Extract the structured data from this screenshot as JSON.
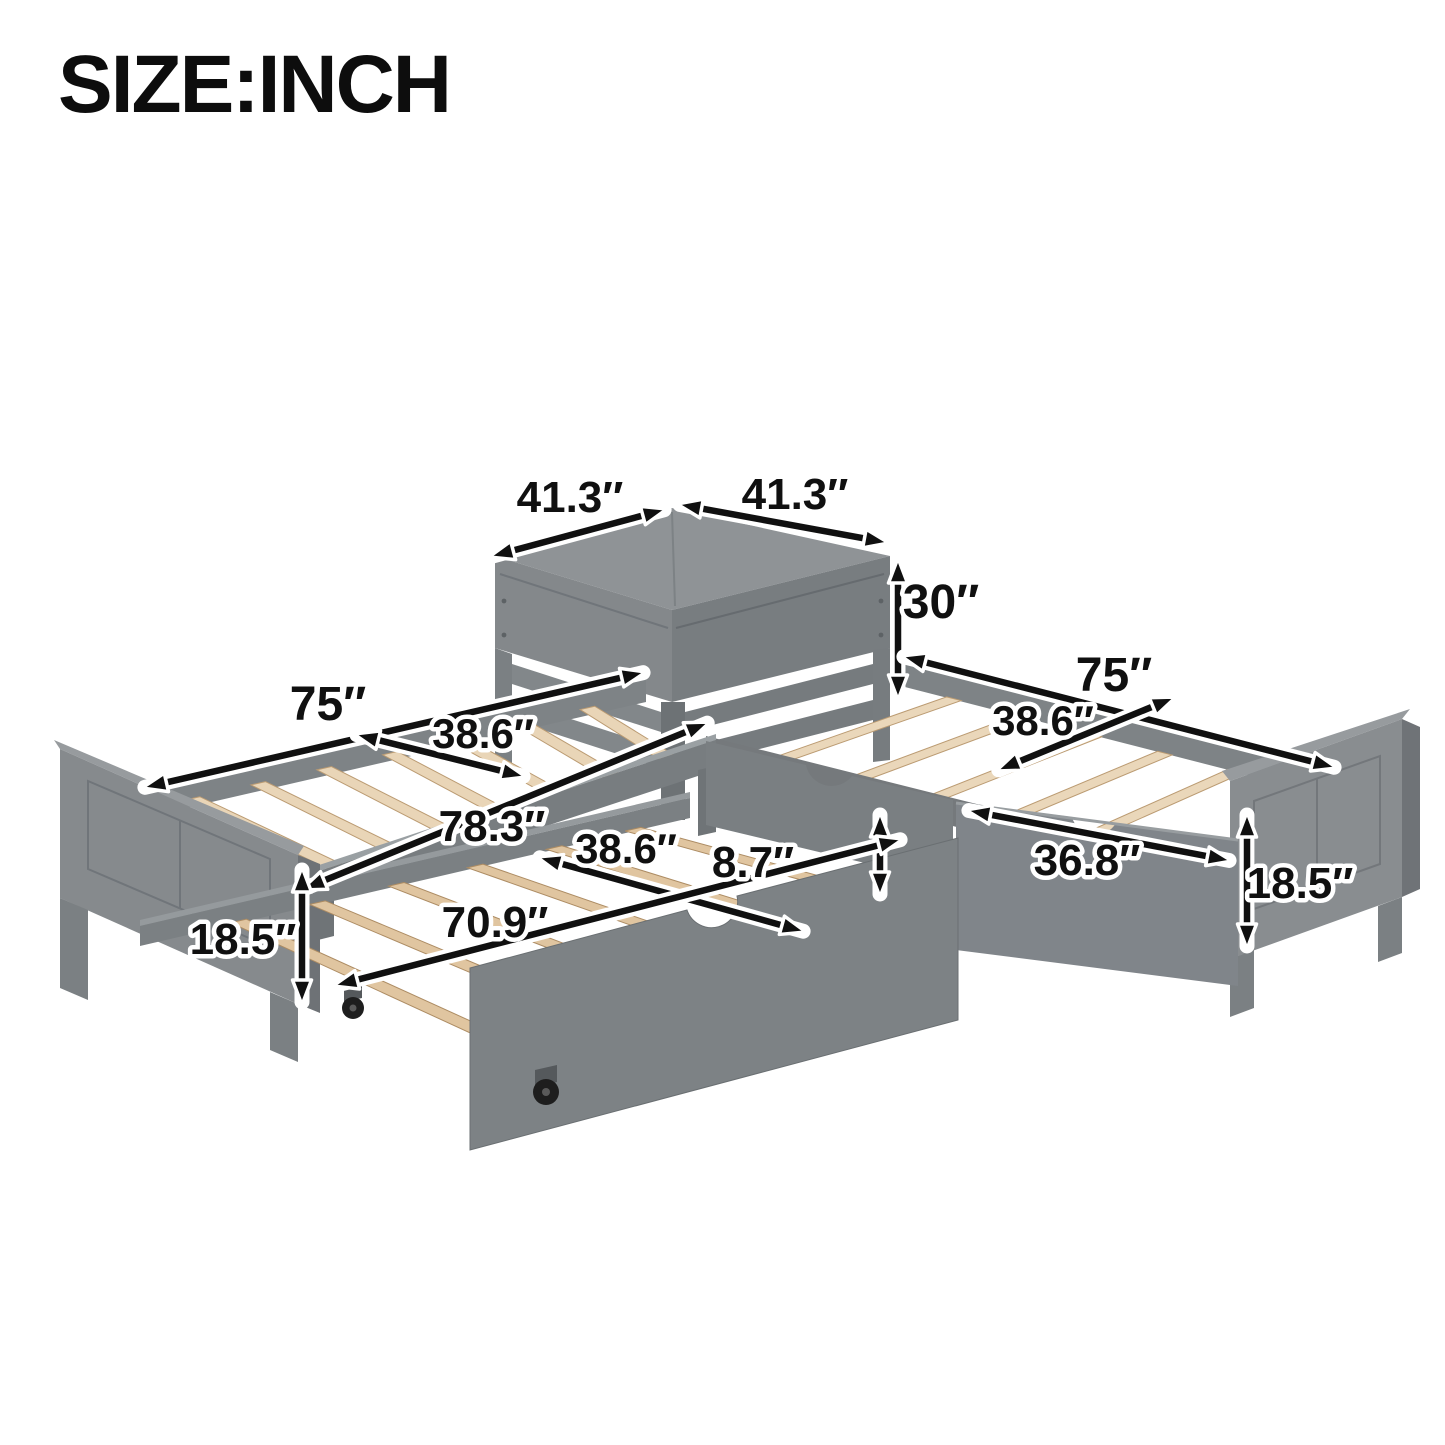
{
  "title": "SIZE:INCH",
  "units": "INCH",
  "colors": {
    "background": "#ffffff",
    "frame_gray": "#83878a",
    "frame_gray_dark": "#6f7477",
    "frame_gray_light": "#979b9e",
    "slat_wood": "#e9d5b7",
    "trundle_slat_wood": "#e0c5a0",
    "dimension_line": "#101010",
    "dimension_halo": "#ffffff",
    "caster_black": "#1e1e1e"
  },
  "dimensions": {
    "table_top_left": "41.3″",
    "table_top_right": "41.3″",
    "table_height": "30″",
    "left_bed_length": "75″",
    "left_bed_width": "38.6″",
    "right_bed_length": "75″",
    "right_bed_width": "38.6″",
    "overall_length": "78.3″",
    "trundle_width": "38.6″",
    "trundle_front_height": "8.7″",
    "trundle_length": "70.9″",
    "drawer_front_width": "36.8″",
    "left_footboard_height": "18.5″",
    "right_footboard_height": "18.5″"
  }
}
